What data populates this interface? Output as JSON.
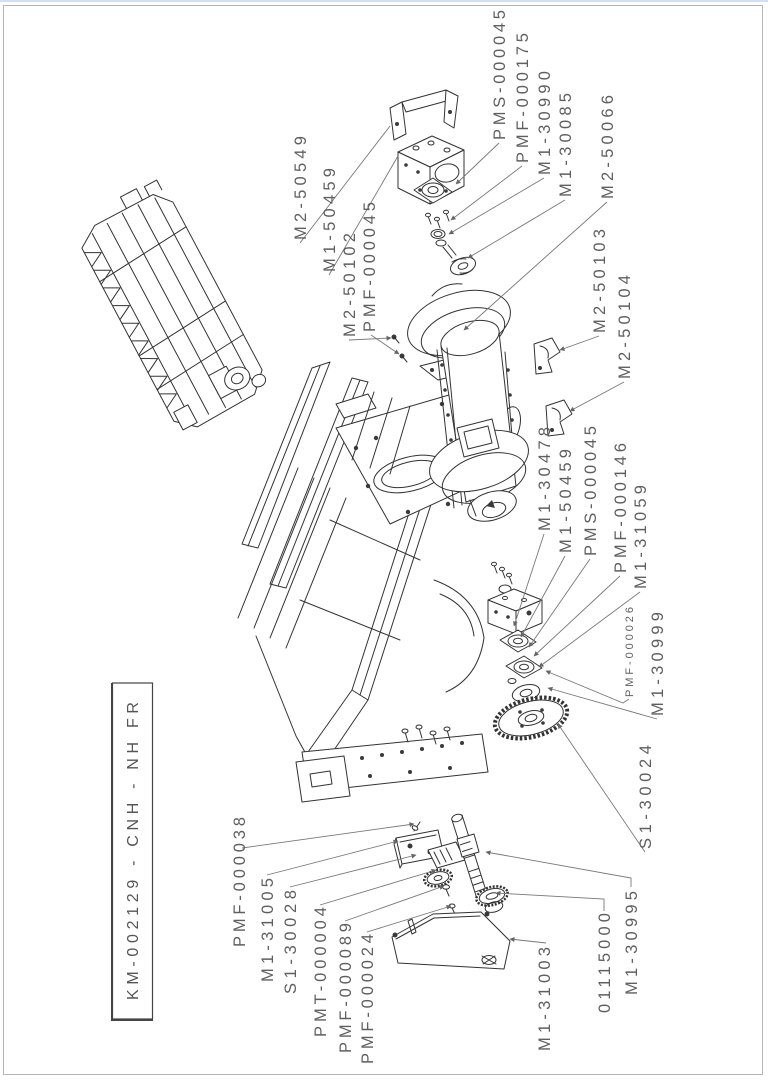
{
  "page": {
    "background": "#ffffff",
    "top_edge_color": "#cfe1f2",
    "border_color": "#b5b5b5",
    "drawing_line_color": "#333333",
    "label_color": "#5f5f5f"
  },
  "title_block": {
    "text": "KM-002129 - CNH - NH FR"
  },
  "part_labels": [
    {
      "text": "M2-50549"
    },
    {
      "text": "M1-50459"
    },
    {
      "text": "M2-50102"
    },
    {
      "text": "PMF-000045"
    },
    {
      "text": "PMS-000045"
    },
    {
      "text": "PMF-000175"
    },
    {
      "text": "M1-30990"
    },
    {
      "text": "M1-30085"
    },
    {
      "text": "M2-50066"
    },
    {
      "text": "M2-50103"
    },
    {
      "text": "M2-50104"
    },
    {
      "text": "M1-30478"
    },
    {
      "text": "M1-50459"
    },
    {
      "text": "PMS-000045"
    },
    {
      "text": "PMF-000146"
    },
    {
      "text": "M1-31059"
    },
    {
      "text": "PMF-000026"
    },
    {
      "text": "M1-30999"
    },
    {
      "text": "S1-30024"
    },
    {
      "text": "PMF-000038"
    },
    {
      "text": "M1-31005"
    },
    {
      "text": "S1-30028"
    },
    {
      "text": "PMT-000004"
    },
    {
      "text": "PMF-000089"
    },
    {
      "text": "PMF-000024"
    },
    {
      "text": "M1-31003"
    },
    {
      "text": "01115000"
    },
    {
      "text": "M1-30995"
    }
  ]
}
